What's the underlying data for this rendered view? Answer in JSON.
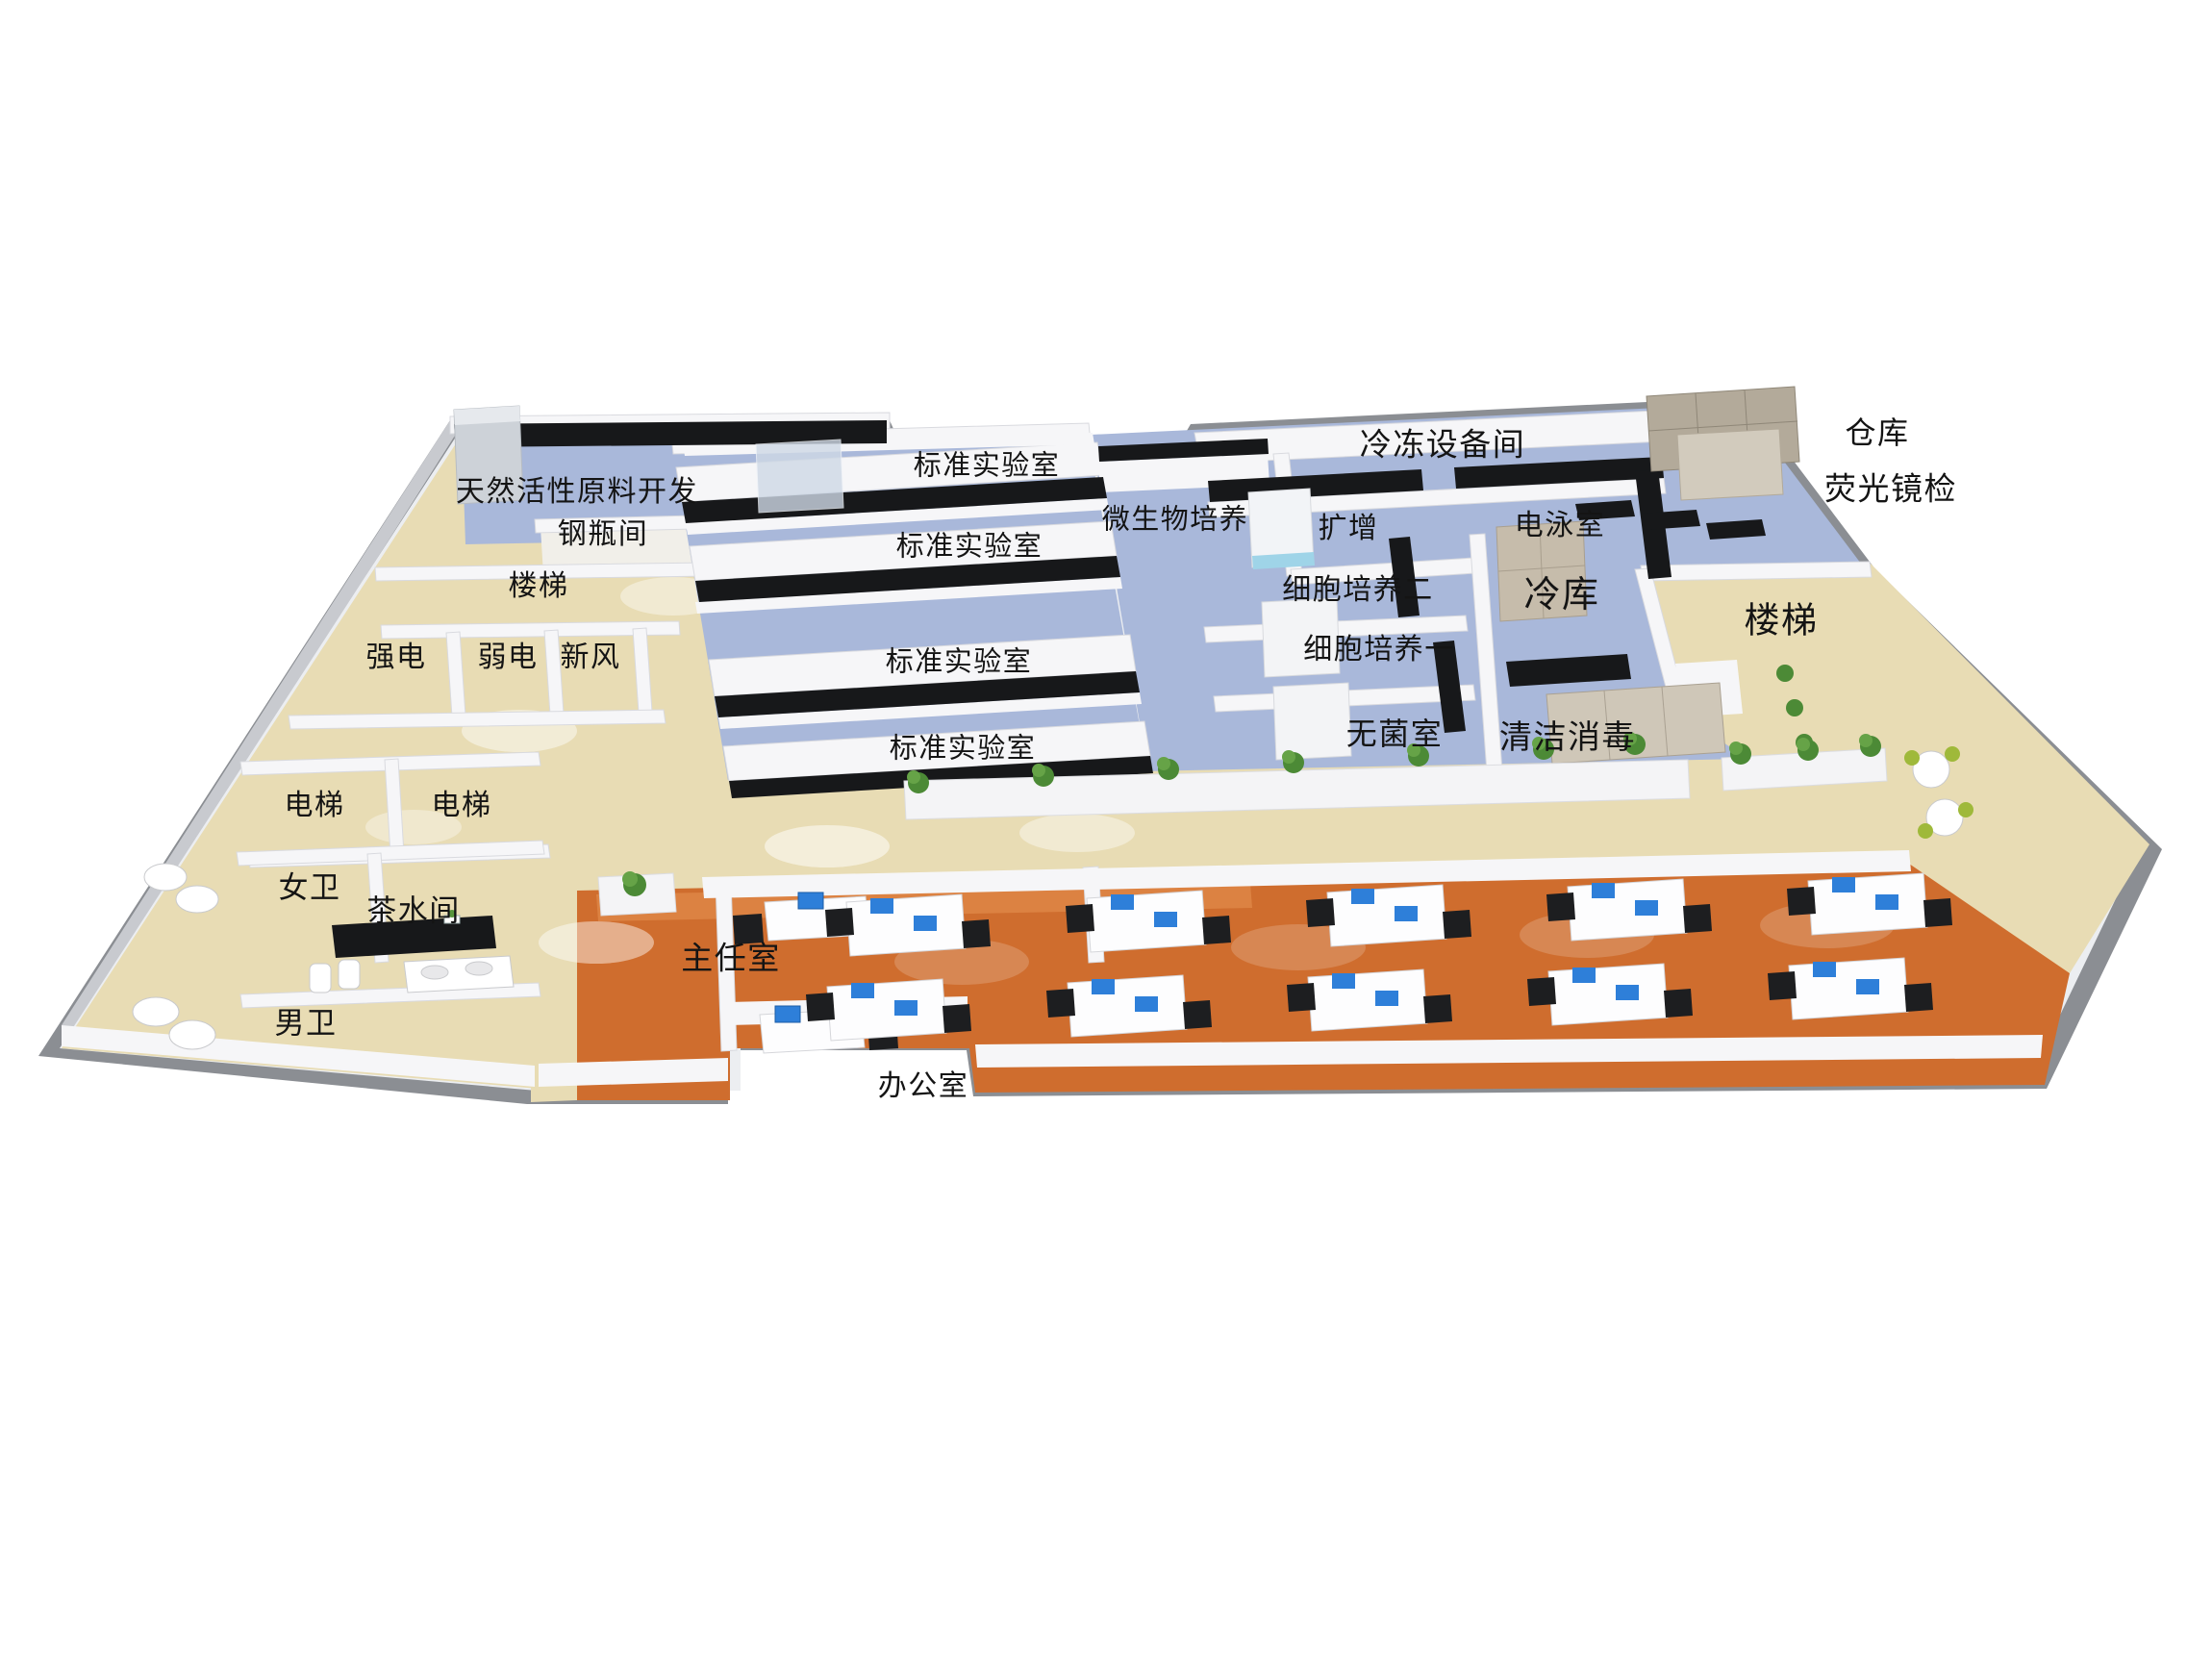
{
  "scene": {
    "description": "3D isometric rendering of a laboratory and office floor plan",
    "colors": {
      "lab_floor": "#a9b8da",
      "corridor_floor": "#e8dcb4",
      "office_floor": "#cf6d2e",
      "slab_gray": "#8b8e93",
      "wall_white": "#f6f6f8",
      "bench_black": "#17181a",
      "cabinet_tan": "#b3aa9a",
      "plant_green": "#4c8a36",
      "label_color": "#141414"
    }
  },
  "rooms": [
    {
      "id": "natural-active-material-dev",
      "label": "天然活性原料开发"
    },
    {
      "id": "gas-cylinder-room",
      "label": "钢瓶间"
    },
    {
      "id": "stairs-left",
      "label": "楼梯"
    },
    {
      "id": "strong-power",
      "label": "强电"
    },
    {
      "id": "weak-power",
      "label": "弱电"
    },
    {
      "id": "fresh-air",
      "label": "新风"
    },
    {
      "id": "elevator-left",
      "label": "电梯"
    },
    {
      "id": "elevator-right",
      "label": "电梯"
    },
    {
      "id": "womens-restroom",
      "label": "女卫"
    },
    {
      "id": "tea-room",
      "label": "茶水间"
    },
    {
      "id": "mens-restroom",
      "label": "男卫"
    },
    {
      "id": "standard-lab-1",
      "label": "标准实验室"
    },
    {
      "id": "standard-lab-2",
      "label": "标准实验室"
    },
    {
      "id": "standard-lab-3",
      "label": "标准实验室"
    },
    {
      "id": "standard-lab-4",
      "label": "标准实验室"
    },
    {
      "id": "microbial-culture",
      "label": "微生物培养"
    },
    {
      "id": "freezer-equipment-room",
      "label": "冷冻设备间"
    },
    {
      "id": "amplification",
      "label": "扩增"
    },
    {
      "id": "electrophoresis-room",
      "label": "电泳室"
    },
    {
      "id": "cell-culture-2",
      "label": "细胞培养二"
    },
    {
      "id": "cold-storage",
      "label": "冷库"
    },
    {
      "id": "cell-culture-1",
      "label": "细胞培养一"
    },
    {
      "id": "sterile-room",
      "label": "无菌室"
    },
    {
      "id": "cleaning-disinfection",
      "label": "清洁消毒"
    },
    {
      "id": "warehouse",
      "label": "仓库"
    },
    {
      "id": "fluorescence-microscopy",
      "label": "荧光镜检"
    },
    {
      "id": "stairs-right",
      "label": "楼梯"
    },
    {
      "id": "director-office",
      "label": "主任室"
    },
    {
      "id": "office",
      "label": "办公室"
    }
  ]
}
